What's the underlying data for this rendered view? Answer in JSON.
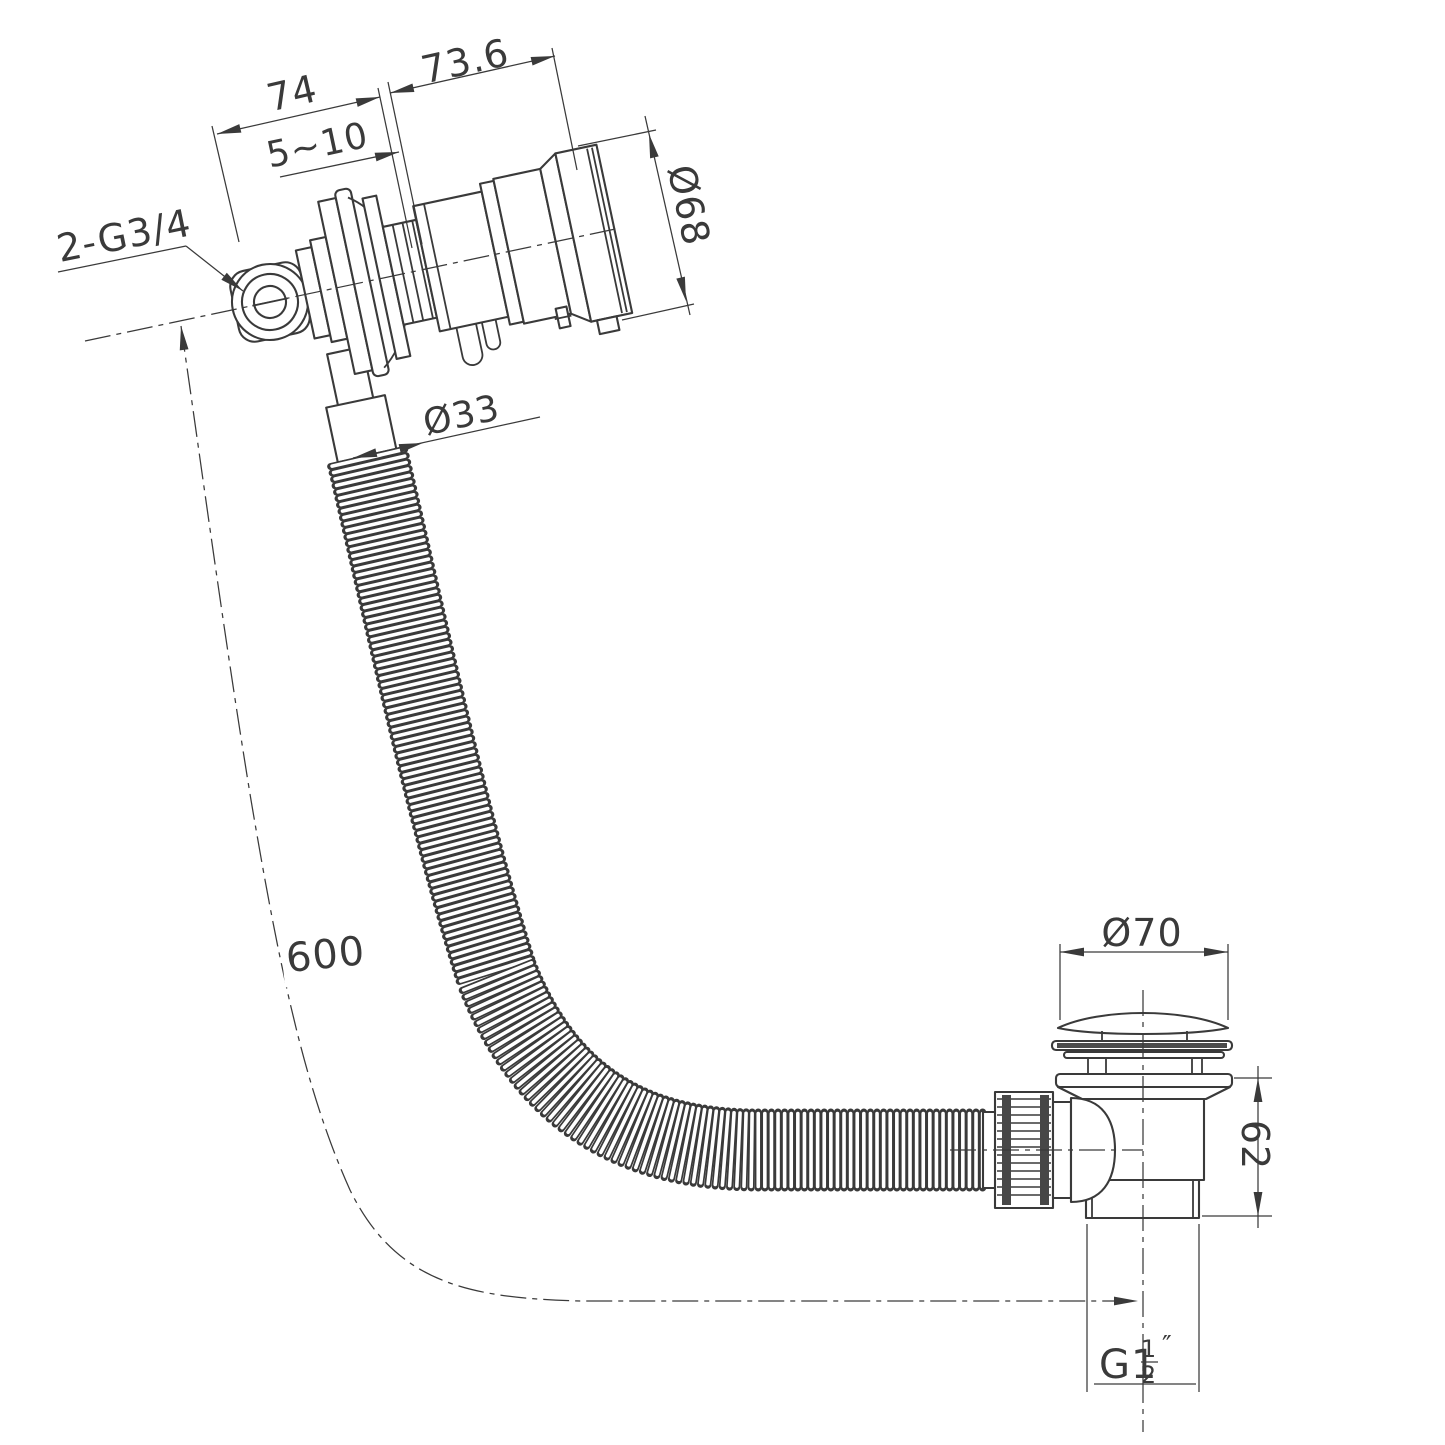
{
  "title": "Bath filler with overflow, flexible hose and clicker waste - dimensioned technical drawing",
  "colors": {
    "background": "#ffffff",
    "line": "#3a3a3a"
  },
  "dimensions": {
    "filler_projection": "74",
    "filler_body_length": "73.6",
    "wall_thickness_range": "5~10",
    "overflow_knob_diameter": "Ø68",
    "inlet_threads": "2-G3/4",
    "hose_diameter": "Ø33",
    "hose_length": "600",
    "waste_cap_diameter": "Ø70",
    "waste_body_height": "62",
    "waste_thread_prefix": "G1",
    "waste_thread_numerator": "1",
    "waste_thread_denominator": "2",
    "waste_thread_unit": "″"
  }
}
